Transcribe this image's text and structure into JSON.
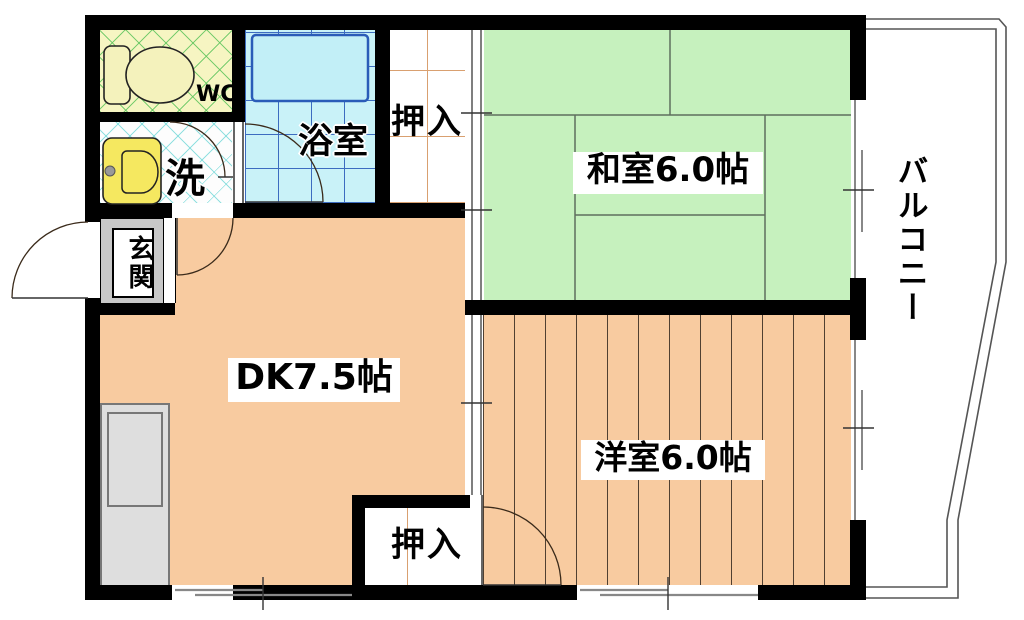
{
  "plan": {
    "type_note": "apartment floor plan",
    "rooms": {
      "wc": {
        "label": "WC"
      },
      "washroom": {
        "label": "洗"
      },
      "bathroom": {
        "label": "浴室"
      },
      "closet_top": {
        "label": "押入"
      },
      "closet_bottom": {
        "label": "押入"
      },
      "japanese_room": {
        "label": "和室6.0帖"
      },
      "dining_kitchen": {
        "label": "DK7.5帖"
      },
      "western_room": {
        "label": "洋室6.0帖"
      },
      "entrance": {
        "label": "玄関"
      },
      "balcony": {
        "label": "バルコニー"
      }
    },
    "colors": {
      "wall": "#000000",
      "tatami_green": "#c6f1be",
      "flooring_peach": "#f8cba0",
      "bath_cyan": "#c9f2f8",
      "bath_grid_blue": "#3c6cc0",
      "wc_yellow": "#f6f5c2",
      "entrance_gray": "#c8c8c8",
      "fixture_yellow": "#f5e860",
      "closet_grid_tan": "#d9a070"
    }
  }
}
